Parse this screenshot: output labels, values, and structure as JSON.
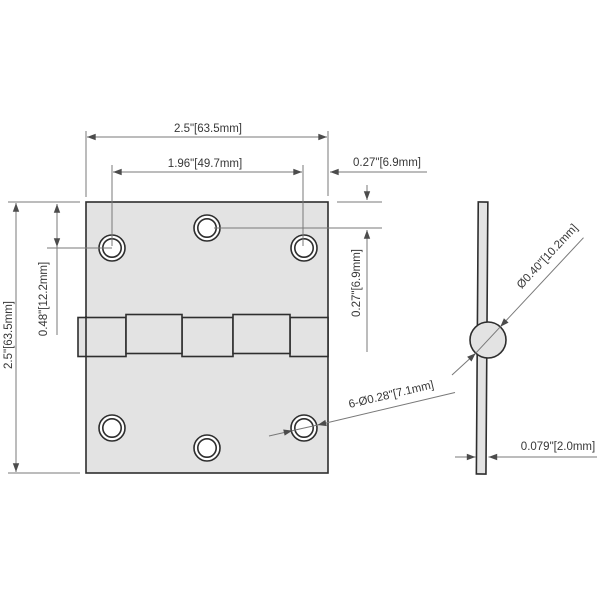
{
  "drawing_type": "hinge-dimension-diagram",
  "front_view": {
    "labels": {
      "overall_width": "2.5\"[63.5mm]",
      "hole_spacing": "1.96\"[49.7mm]",
      "edge_to_hole_horizontal": "0.27\"[6.9mm]",
      "overall_height": "2.5\"[63.5mm]",
      "top_to_side_hole": "0.48\"[12.2mm]",
      "top_to_center_hole": "0.27\"[6.9mm]",
      "hole_diameter_callout": "6-Ø0.28\"[7.1mm]"
    },
    "hole_count": 6,
    "knuckle_count": 5
  },
  "side_view": {
    "labels": {
      "knuckle_diameter": "Ø0.40\"[10.2mm]",
      "leaf_thickness": "0.079\"[2.0mm]"
    }
  },
  "colors": {
    "background": "#ffffff",
    "plate_fill": "#e3e3e3",
    "object_outline": "#2e2e2e",
    "dimension_line": "#787878",
    "arrowhead": "#4c4c4c",
    "text": "#383838"
  }
}
